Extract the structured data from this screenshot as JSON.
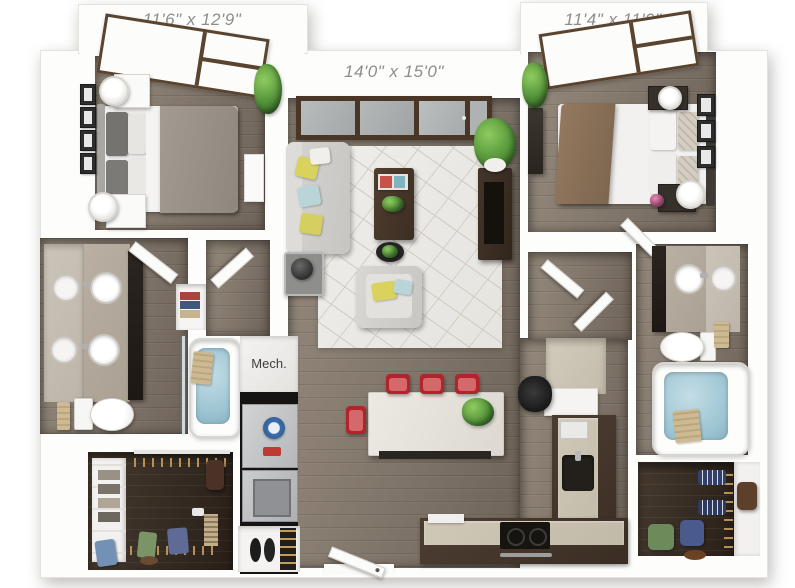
{
  "plan": {
    "type": "3d-floor-plan",
    "bedroom1": {
      "dimensions": "11'6\" x 12'9\""
    },
    "living_room": {
      "dimensions": "14'0\" x 15'0\""
    },
    "bedroom2": {
      "dimensions": "11'4\" x 11'9\""
    },
    "mech_room": {
      "label": "Mech."
    }
  },
  "colors": {
    "background": "#ffffff",
    "walls": "#fdfdfc",
    "wood_floor": "#84786c",
    "closet_floor": "#332a22",
    "label_text": "#8d8d8d",
    "mech_text": "#3e3e3e",
    "window_frame": "#5a442f",
    "balcony_door_frame": "#4a3627",
    "sofa_gray": "#d0cfcc",
    "rug": "#ebe9e5",
    "bed1_duvet": "#9a9289",
    "bed2_throw": "#8b7360",
    "dining_chair_red": "#b2242b",
    "countertop_beige": "#c9c1b0",
    "cabinet_espresso": "#3f3226",
    "bath_water_blue": "#9cc4d2",
    "vanity_tan": "#b3a99c",
    "plant_green": "#55953a",
    "pillow_yellow": "#d9d35e",
    "pillow_blue": "#bad5d8"
  }
}
